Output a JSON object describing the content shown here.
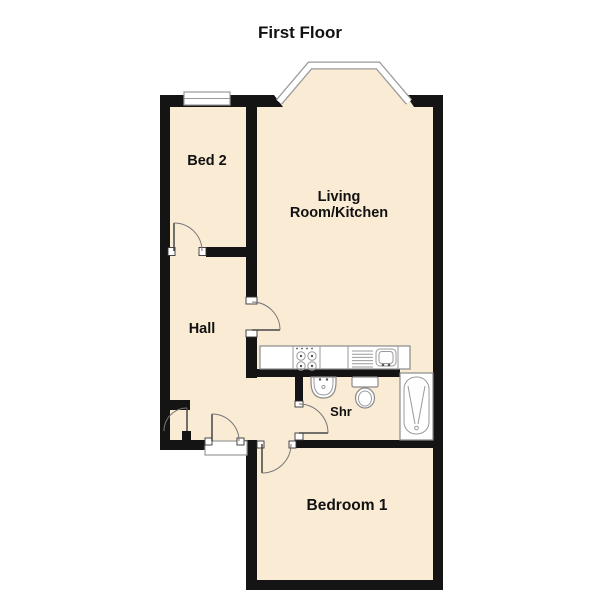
{
  "title": "First Floor",
  "labels": {
    "bed2": "Bed 2",
    "living_line1": "Living",
    "living_line2": "Room/Kitchen",
    "hall": "Hall",
    "shower": "Shr",
    "bedroom1": "Bedroom 1"
  },
  "rooms": [
    {
      "name": "Bed 2"
    },
    {
      "name": "Living Room/Kitchen"
    },
    {
      "name": "Hall"
    },
    {
      "name": "Shr"
    },
    {
      "name": "Bedroom 1"
    }
  ],
  "fixtures": [
    "bay-window",
    "window",
    "kitchen-counter",
    "hob-4-burner",
    "sink-with-drainer",
    "wash-basin",
    "toilet",
    "shower-tray",
    "entrance-door",
    "internal-door",
    "cupboard-door"
  ],
  "colors": {
    "wall": "#141414",
    "floor": "#FAEBD5",
    "fixture_outline": "#8a8a8a",
    "window_gray": "#9a9a9a",
    "door_arc": "#777777",
    "text": "#111111",
    "background": "#FFFFFF"
  }
}
